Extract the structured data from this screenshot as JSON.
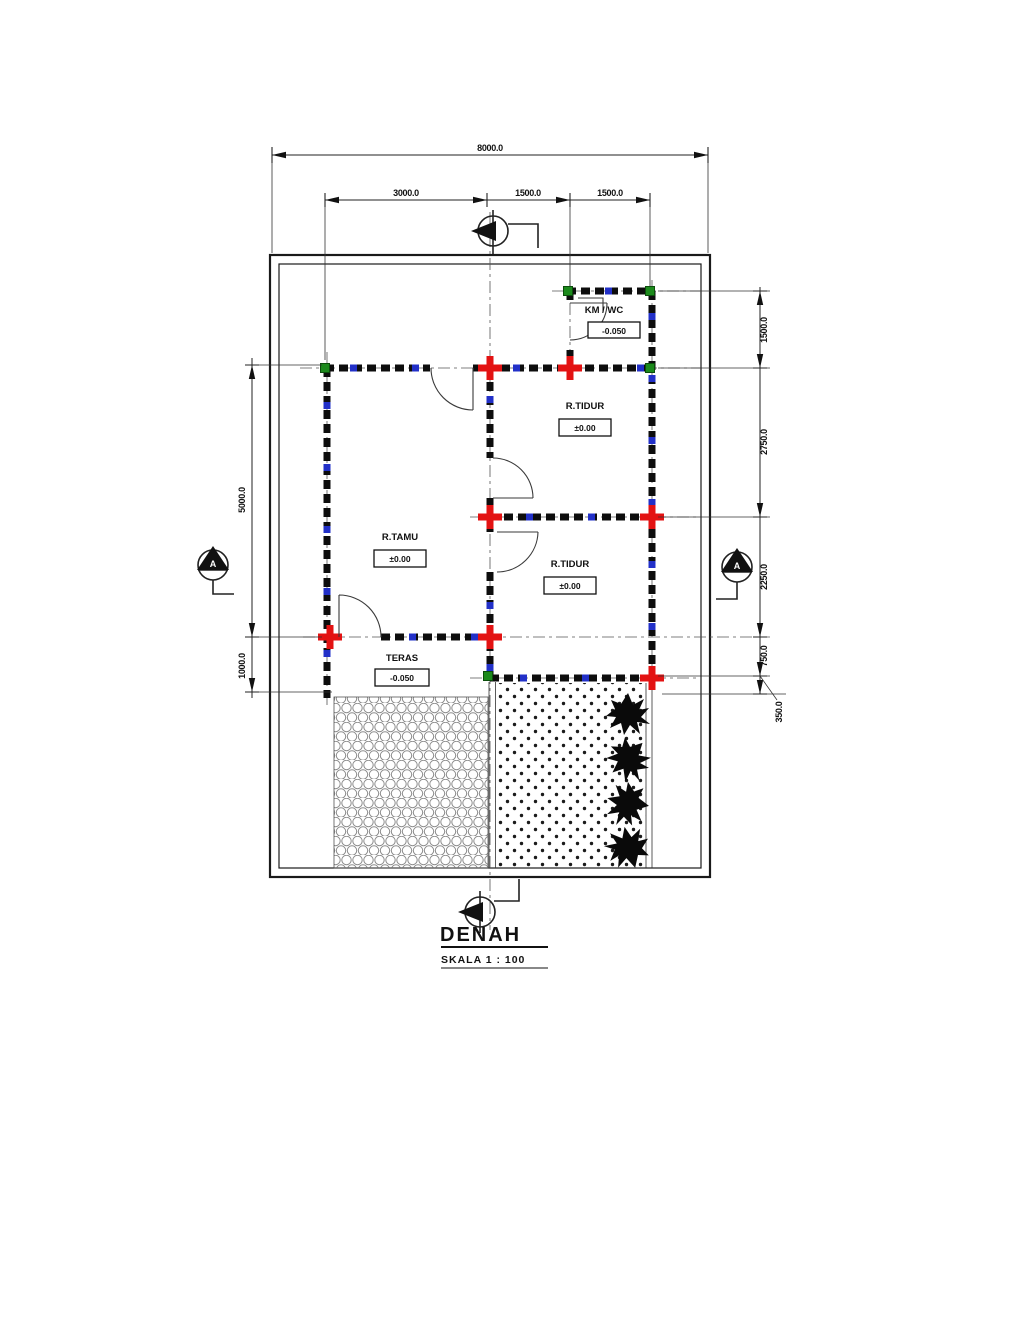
{
  "sheet": {
    "title": "DENAH",
    "scale_label": "SKALA 1 : 100"
  },
  "dimensions": {
    "top_total": "8000.0",
    "top_segments": [
      "3000.0",
      "1500.0",
      "1500.0"
    ],
    "left_segments": [
      "5000.0",
      "1000.0"
    ],
    "right_segments": [
      "1500.0",
      "2750.0",
      "2250.0",
      "750.0",
      "350.0"
    ]
  },
  "rooms": {
    "kmwc": {
      "name": "KM / WC",
      "level": "-0.050"
    },
    "bedroom1": {
      "name": "R.TIDUR",
      "level": "±0.00"
    },
    "livingroom": {
      "name": "R.TAMU",
      "level": "±0.00"
    },
    "bedroom2": {
      "name": "R.TIDUR",
      "level": "±0.00"
    },
    "teras": {
      "name": "TERAS",
      "level": "-0.050"
    }
  },
  "section_markers": {
    "left": "A",
    "right": "A"
  },
  "colors": {
    "wall": "#0d0d0d",
    "column": "#e31212",
    "corner_column": "#1c8a1c",
    "window": "#2230c8"
  }
}
